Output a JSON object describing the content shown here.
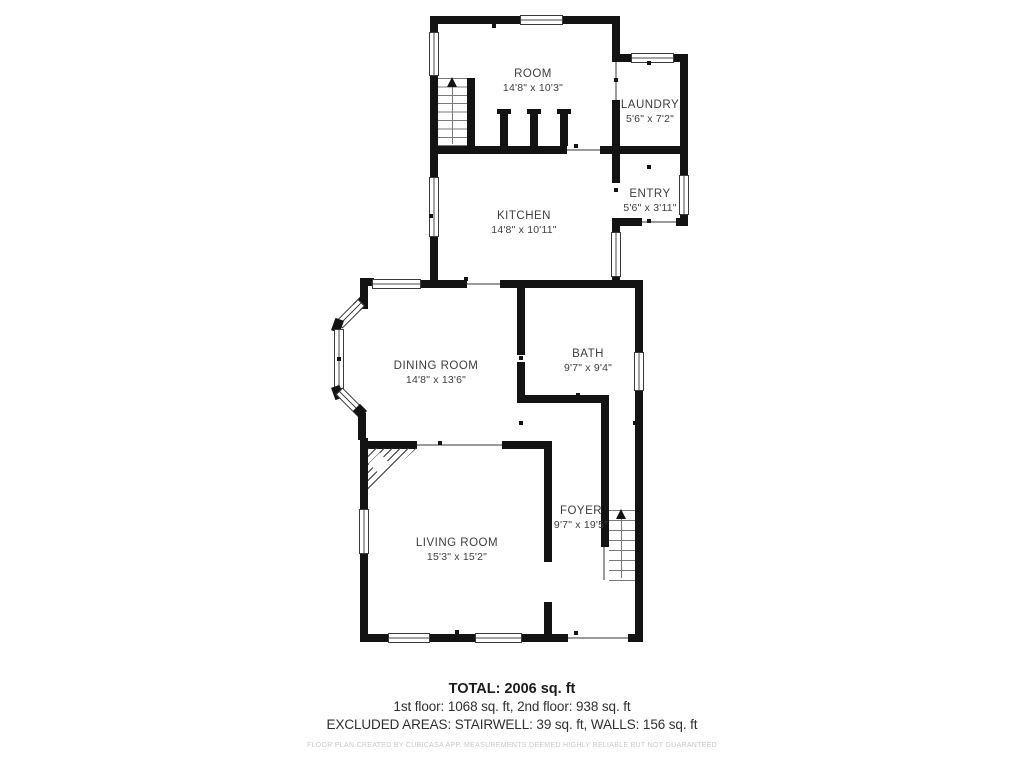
{
  "rooms": [
    {
      "id": "room",
      "name": "ROOM",
      "dims": "14'8\" x 10'3\""
    },
    {
      "id": "laundry",
      "name": "LAUNDRY",
      "dims": "5'6\" x 7'2\""
    },
    {
      "id": "kitchen",
      "name": "KITCHEN",
      "dims": "14'8\" x 10'11\""
    },
    {
      "id": "entry",
      "name": "ENTRY",
      "dims": "5'6\" x 3'11\""
    },
    {
      "id": "dining",
      "name": "DINING ROOM",
      "dims": "14'8\" x 13'6\""
    },
    {
      "id": "bath",
      "name": "BATH",
      "dims": "9'7\" x 9'4\""
    },
    {
      "id": "living",
      "name": "LIVING ROOM",
      "dims": "15'3\" x 15'2\""
    },
    {
      "id": "foyer",
      "name": "FOYER",
      "dims": "9'7\" x 19'5\""
    }
  ],
  "summary": {
    "total": "TOTAL: 2006 sq. ft",
    "floors": "1st floor: 1068 sq. ft, 2nd floor: 938 sq. ft",
    "excluded": "EXCLUDED AREAS: STAIRWELL: 39 sq. ft, WALLS: 156 sq. ft",
    "disclaimer": "FLOOR PLAN CREATED BY CUBICASA APP. MEASUREMENTS DEEMED HIGHLY RELIABLE BUT NOT GUARANTEED"
  },
  "colors": {
    "wall": "#131313",
    "label_text": "#3e3e3e",
    "summary_text": "#2f2f2f",
    "disclaimer_text": "#c8c8c8",
    "background": "#ffffff"
  }
}
